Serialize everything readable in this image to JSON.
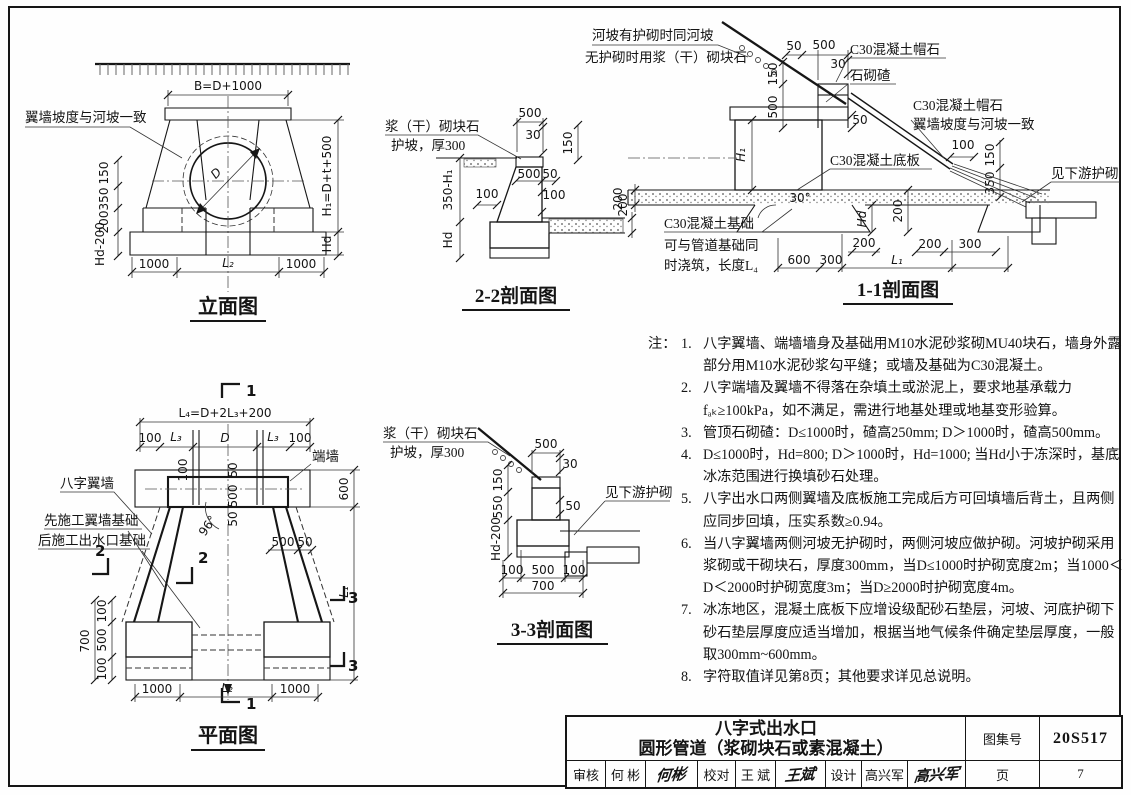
{
  "elevation": {
    "title": "立面图",
    "slope_label": "翼墙坡度与河坡一致",
    "dim_b": "B=D+1000",
    "dim_d": "D",
    "left_dims": [
      "150",
      "350",
      "200",
      "Hd-200"
    ],
    "dim_h1": "H₁=D+t+500",
    "dim_hd": "Hd",
    "bottom_dims": [
      "1000",
      "L₂",
      "1000"
    ]
  },
  "s22": {
    "title": "2-2剖面图",
    "label1": "浆（干）砌块石",
    "label2": "护坡，厚300",
    "d500": "500",
    "d30": "30",
    "d150": "150",
    "d500b": "500",
    "d50": "50",
    "d100l": "100",
    "d100r": "100",
    "d350h1": "350-H₁",
    "dhd": "Hd",
    "d200": "200"
  },
  "s11": {
    "title": "1-1剖面图",
    "slope1": "河坡有护砌时同河坡",
    "slope2": "无护砌时用浆（干）砌块石",
    "cap1": "C30混凝土帽石",
    "zha": "石砌碴",
    "cap2": "C30混凝土帽石",
    "wing": "翼墙坡度与河坡一致",
    "slab": "C30混凝土底板",
    "apron": "见下游护砌",
    "fnd1": "C30混凝土基础",
    "fnd2": "可与管道基础同",
    "fnd3": "时浇筑，长度L₄",
    "d50t": "50",
    "d500t": "500",
    "d30": "30",
    "d150l": "150",
    "d500l": "500",
    "d50m": "50",
    "dh1": "H₁",
    "d100": "100",
    "d150r": "150",
    "d350": "350",
    "d200l": "200",
    "dang": "30°",
    "dhd": "Hd",
    "d200m": "200",
    "d200s": "200",
    "d600": "600",
    "d300": "300",
    "dl1": "L₁",
    "d200r": "200",
    "d300r": "300"
  },
  "plan": {
    "title": "平面图",
    "endwall": "端墙",
    "wing": "八字翼墙",
    "fnd1": "先施工翼墙基础",
    "fnd2": "后施工出水口基础",
    "dl4": "L₄=D+2L₃+200",
    "row2": [
      "100",
      "L₃",
      "D",
      "L₃",
      "100"
    ],
    "dv": [
      "100",
      "50",
      "500",
      "50"
    ],
    "dang": "96°",
    "d500h": "500",
    "d50h": "50",
    "d600": "600",
    "dl1": "L₁",
    "left": [
      "100",
      "500",
      "100"
    ],
    "d700": "700",
    "bottom": [
      "1000",
      "L₂",
      "1000"
    ],
    "m1": "1",
    "m2": "2",
    "m3": "3"
  },
  "s33": {
    "title": "3-3剖面图",
    "label1": "浆（干）砌块石",
    "label2": "护坡，厚300",
    "apron": "见下游护砌",
    "d500": "500",
    "d30": "30",
    "d150": "150",
    "d550": "550",
    "d50": "50",
    "dhd200": "Hd-200",
    "b": [
      "100",
      "500",
      "100"
    ],
    "d700": "700"
  },
  "notes": {
    "prefix": "注：",
    "items": [
      {
        "no": "1.",
        "text": "八字翼墙、端墙墙身及基础用M10水泥砂浆砌MU40块石，墙身外露部分用M10水泥砂浆勾平缝；或墙及基础为C30混凝土。"
      },
      {
        "no": "2.",
        "text": "八字端墙及翼墙不得落在杂填土或淤泥上，要求地基承载力fₐₖ≥100kPa，如不满足，需进行地基处理或地基变形验算。"
      },
      {
        "no": "3.",
        "text": "管顶石砌碴：D≤1000时，碴高250mm; D＞1000时，碴高500mm。"
      },
      {
        "no": "4.",
        "text": "D≤1000时，Hd=800; D＞1000时，Hd=1000; 当Hd小于冻深时，基底冰冻范围进行换填砂石处理。"
      },
      {
        "no": "5.",
        "text": "八字出水口两侧翼墙及底板施工完成后方可回填墙后背土，且两侧应同步回填，压实系数≥0.94。"
      },
      {
        "no": "6.",
        "text": "当八字翼墙两侧河坡无护砌时，两侧河坡应做护砌。河坡护砌采用浆砌或干砌块石，厚度300mm，当D≤1000时护砌宽度2m；当1000＜D＜2000时护砌宽度3m；当D≥2000时护砌宽度4m。"
      },
      {
        "no": "7.",
        "text": "冰冻地区，混凝土底板下应增设级配砂石垫层，河坡、河底护砌下砂石垫层厚度应适当增加，根据当地气候条件确定垫层厚度，一般取300mm~600mm。"
      },
      {
        "no": "8.",
        "text": "字符取值详见第8页；其他要求详见总说明。"
      }
    ]
  },
  "tb": {
    "title1": "八字式出水口",
    "title2": "圆形管道（浆砌块石或素混凝土）",
    "atlas_label": "图集号",
    "atlas_no": "20S517",
    "page_label": "页",
    "page_no": "7",
    "review_label": "审核",
    "review_name": "何 彬",
    "review_sig": "何彬",
    "proof_label": "校对",
    "proof_name": "王 斌",
    "proof_sig": "王斌",
    "design_label": "设计",
    "design_name": "高兴军",
    "design_sig": "高兴军"
  }
}
